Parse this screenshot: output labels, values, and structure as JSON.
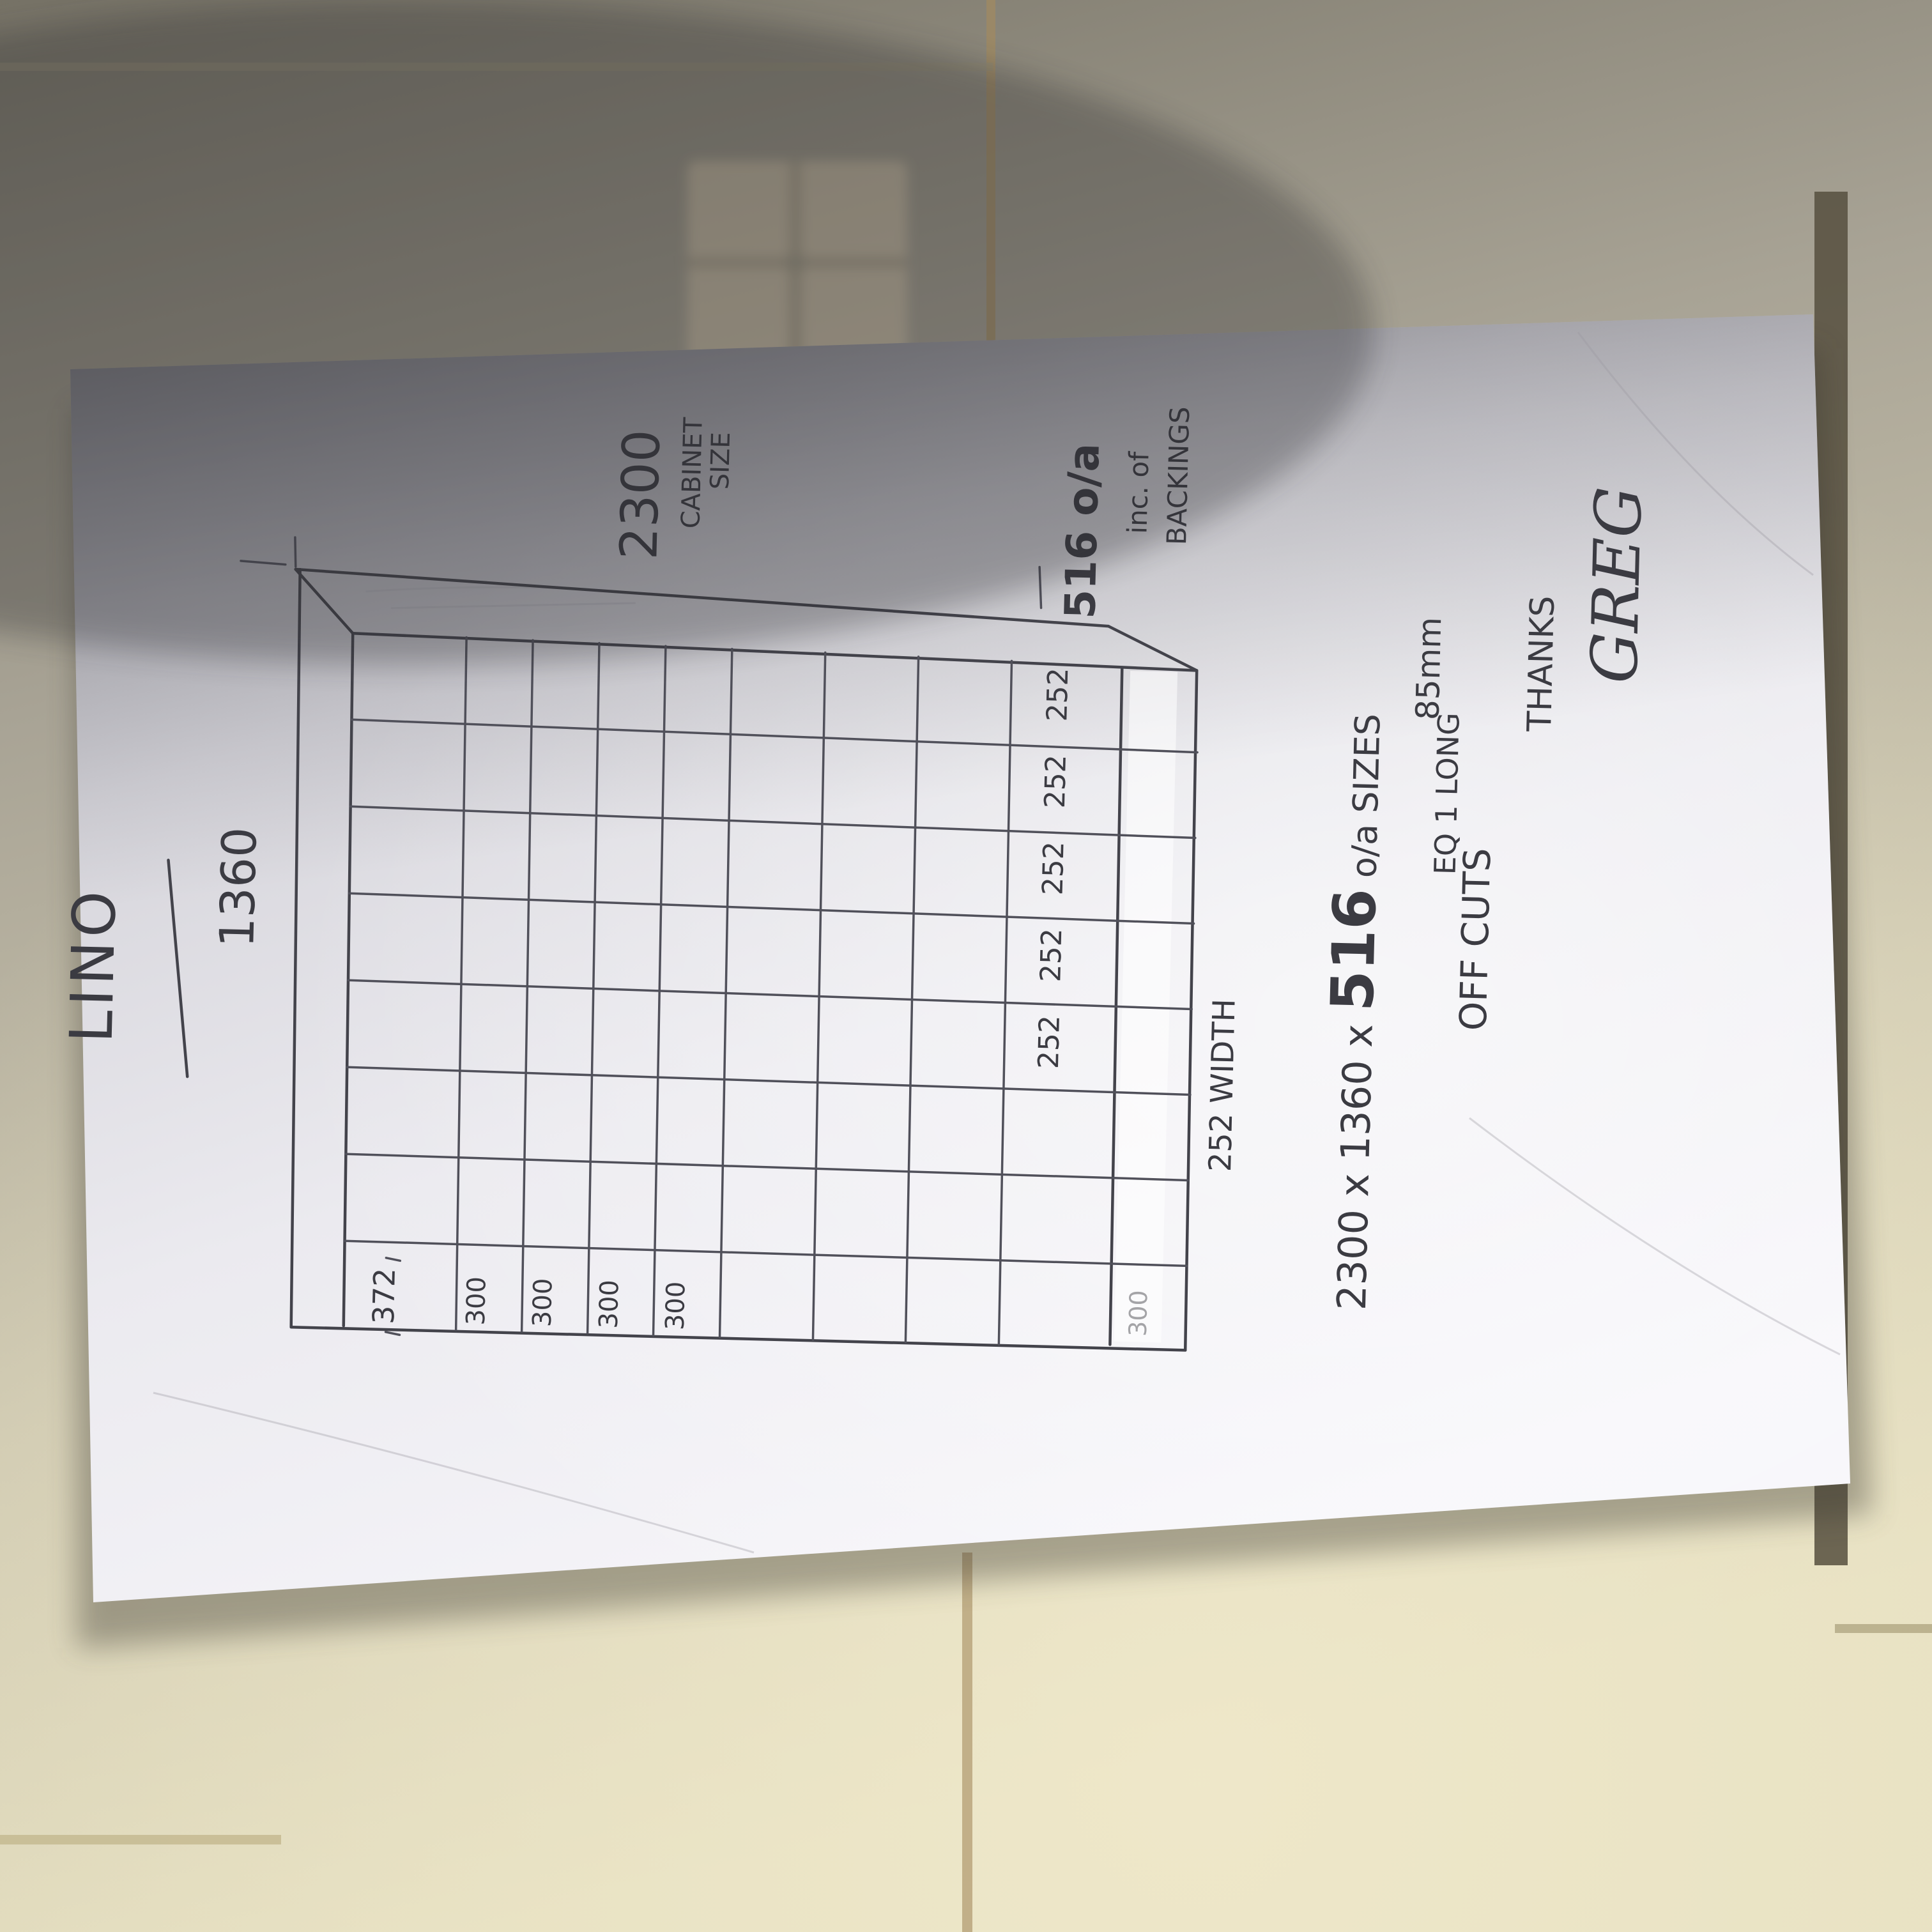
{
  "photo": {
    "description_colors": {
      "tile_light": "#e2dcc2",
      "tile_shadow": "#7e7a6e",
      "grout_tan": "#a48d63",
      "paper_bright": "#f7f6fa",
      "paper_shadow": "#b4b4ba",
      "ink": "#3b3b42"
    }
  },
  "sketch": {
    "title": "LINO",
    "dimensions": {
      "width_label": "1360",
      "height_label": "2300",
      "height_sub1": "CABINET",
      "height_sub2": "SIZE",
      "depth_label": "516 o/a",
      "depth_sub1": "inc. of",
      "depth_sub2": "BACKINGS"
    },
    "row_labels": [
      "372",
      "300",
      "300",
      "300",
      "300"
    ],
    "bottom_band_label": "300",
    "column_labels": [
      "252",
      "252",
      "252",
      "252",
      "252"
    ],
    "column_dim_label": "252 WIDTH",
    "notes": {
      "line1_part1": "2300 x 1360 x ",
      "line1_part2": "516",
      "line1_part3": " o/a SIZES",
      "line2_offcuts": "OFF CUTS",
      "line2_eq": "EQ 1 LONG",
      "line2_mm": "85mm"
    },
    "signoff_thanks": "THANKS",
    "signoff_name": "GREG"
  }
}
